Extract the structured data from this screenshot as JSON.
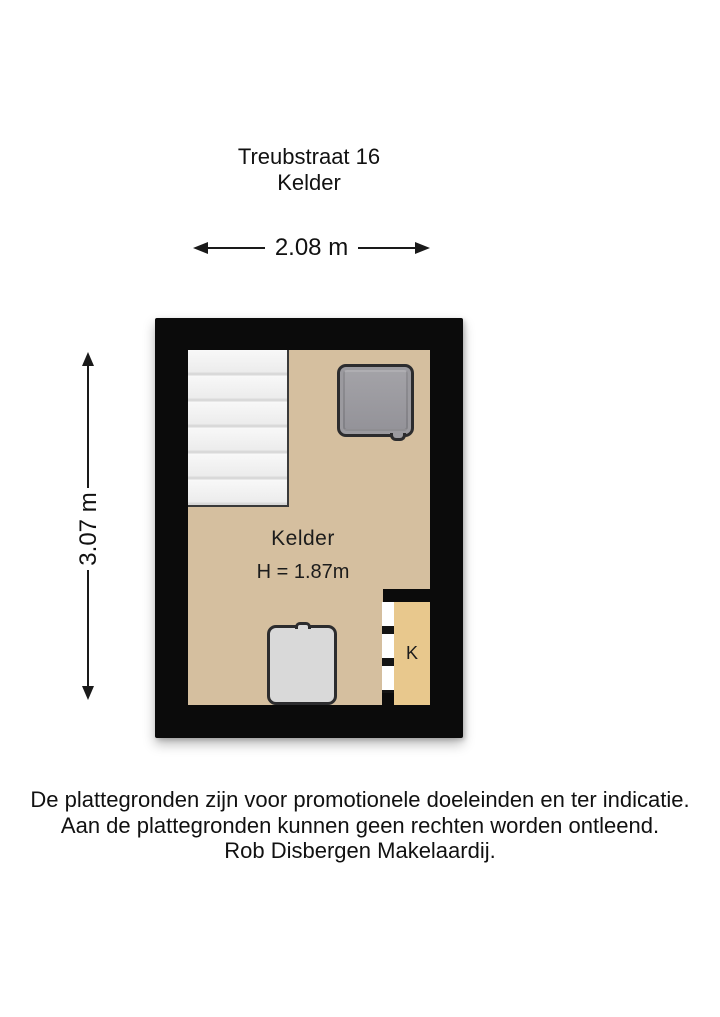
{
  "header": {
    "address": "Treubstraat 16",
    "floor_name": "Kelder"
  },
  "dimensions": {
    "width_label": "2.08 m",
    "height_label": "3.07 m"
  },
  "rooms": {
    "main": {
      "name": "Kelder",
      "ceiling_height": "H = 1.87m"
    },
    "closet": {
      "label": "K"
    }
  },
  "disclaimer": {
    "line1": "De plattegronden zijn voor promotionele doeleinden en ter indicatie.",
    "line2": "Aan de plattegronden kunnen geen rechten worden ontleend.",
    "line3": "Rob Disbergen Makelaardij."
  },
  "colors": {
    "wall": "#0b0b0b",
    "floor": "#d5bf9f",
    "closet_floor": "#e8c88d",
    "stairs": "#f2f2f2",
    "washer_fill": "#9b9a9f",
    "appliance_fill": "#d9d9d9",
    "outline": "#2c2c2e",
    "text": "#111111"
  }
}
